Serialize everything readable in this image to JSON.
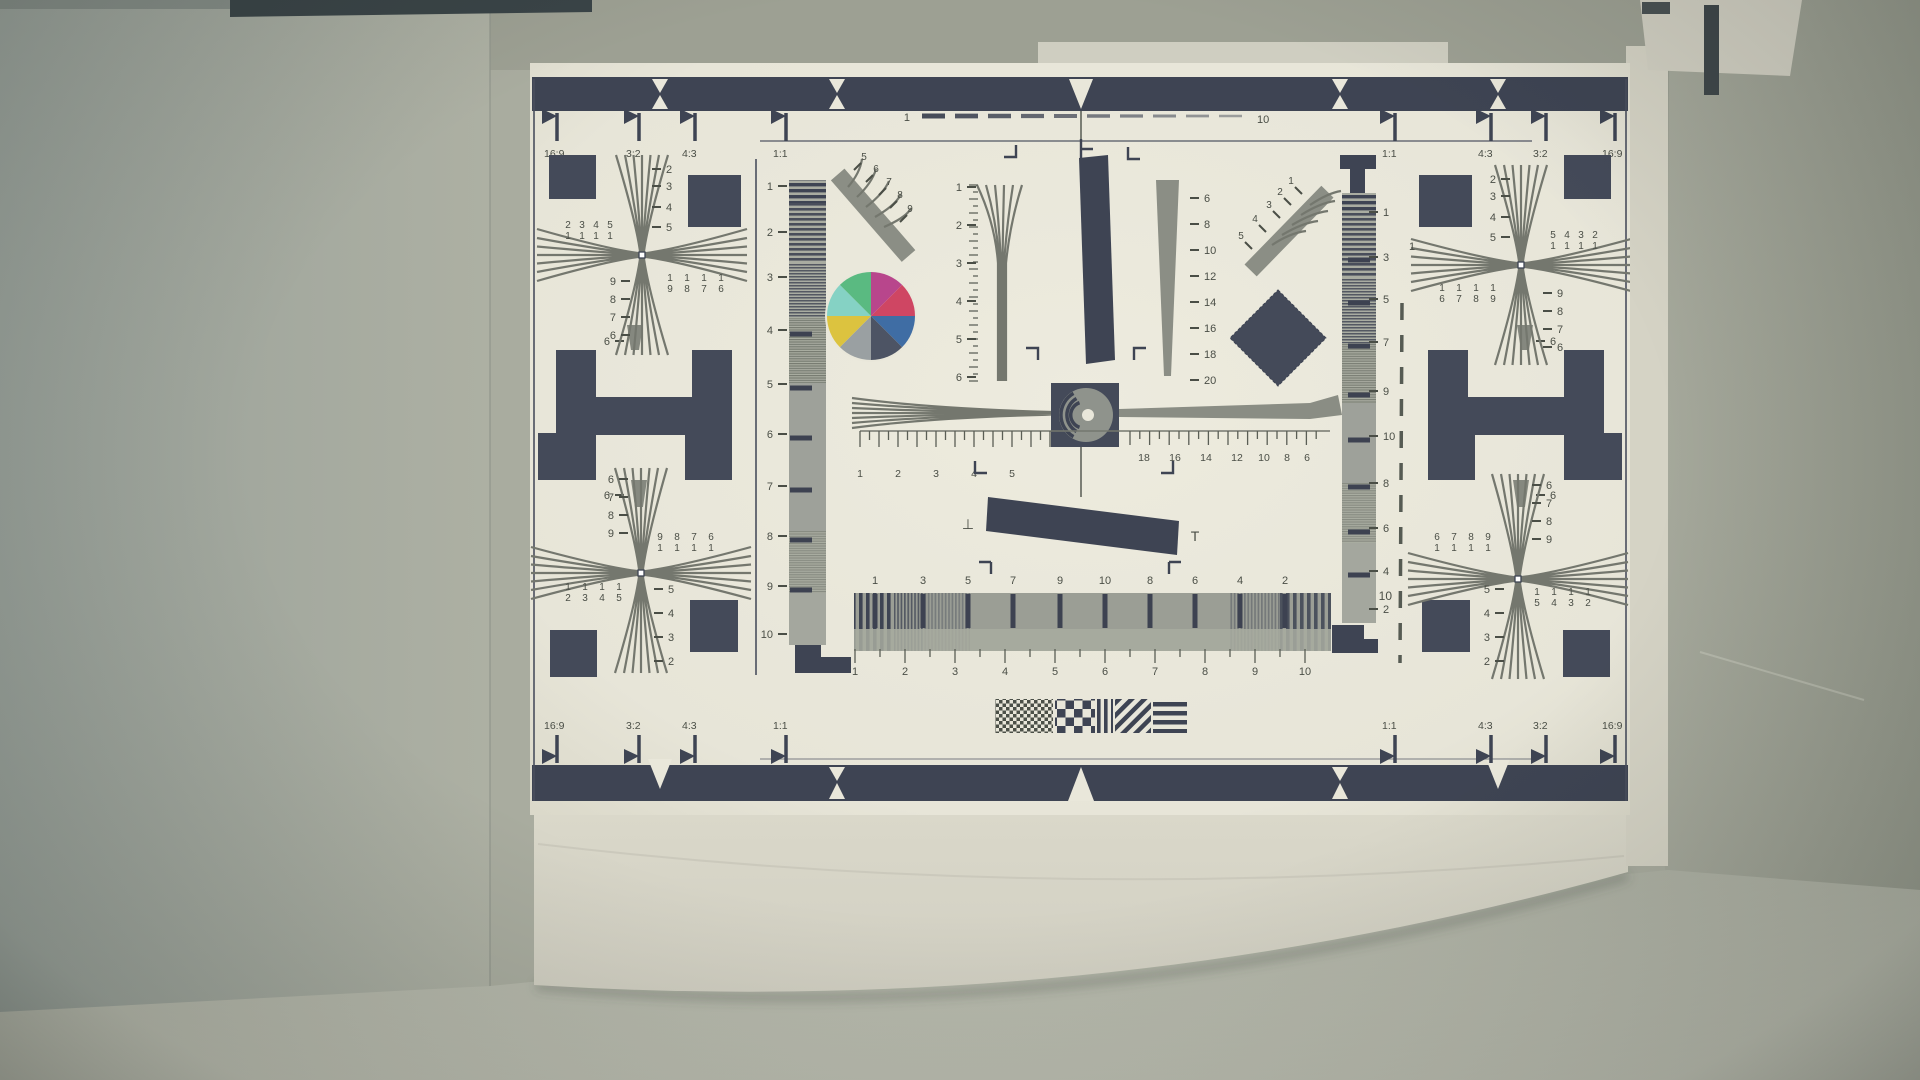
{
  "chart": {
    "aspect": {
      "tl": [
        "16:9",
        "3:2",
        "4:3",
        "1:1"
      ],
      "tr": [
        "1:1",
        "4:3",
        "3:2",
        "16:9"
      ],
      "bl": [
        "16:9",
        "3:2",
        "4:3",
        "1:1"
      ],
      "br": [
        "1:1",
        "4:3",
        "3:2",
        "16:9"
      ]
    },
    "dashed_scale": {
      "start": "1",
      "end": "10"
    },
    "left_scale": [
      "1",
      "2",
      "3",
      "4",
      "5",
      "6",
      "7",
      "8",
      "9",
      "10"
    ],
    "right_scale": [
      "1",
      "3",
      "5",
      "7",
      "9",
      "10",
      "8",
      "6",
      "4",
      "2"
    ],
    "right_dashed_scale": {
      "top": "1",
      "bottom": "10"
    },
    "center_left_wedge_scale": [
      "1",
      "2",
      "3",
      "4",
      "5",
      "6"
    ],
    "center_right_wedge_scale": [
      "6",
      "8",
      "10",
      "12",
      "14",
      "16",
      "18",
      "20"
    ],
    "center_ruler_left": [
      "1",
      "2",
      "3",
      "4",
      "5"
    ],
    "center_ruler_right": [
      "18",
      "16",
      "14",
      "12",
      "10",
      "8",
      "6"
    ],
    "bottom_sweep_top": [
      "1",
      "3",
      "5",
      "7",
      "9",
      "10",
      "8",
      "6",
      "4",
      "2"
    ],
    "bottom_sweep_bottom": [
      "1",
      "2",
      "3",
      "4",
      "5",
      "6",
      "7",
      "8",
      "9",
      "10"
    ],
    "left_fan_scale": [
      "5",
      "6",
      "7",
      "8",
      "9"
    ],
    "right_fan_scale": [
      "5",
      "4",
      "3",
      "2",
      "1"
    ],
    "h_marker_label": "6",
    "perp_marks": {
      "left": "⊥",
      "right": "T"
    },
    "crosses": {
      "tl": {
        "outer_v": [
          "2",
          "3",
          "4",
          "5"
        ],
        "outer_h_row1": [
          "2",
          "3",
          "4",
          "5"
        ],
        "outer_h_row2": [
          "1",
          "1",
          "1",
          "1"
        ],
        "inner_row1": [
          "1",
          "1",
          "1",
          "1"
        ],
        "inner_row2": [
          "9",
          "8",
          "7",
          "6"
        ],
        "inner_v": [
          "9",
          "8",
          "7",
          "6"
        ]
      },
      "tr": {
        "outer_v": [
          "2",
          "3",
          "4",
          "5"
        ],
        "outer_h_row1": [
          "5",
          "4",
          "3",
          "2"
        ],
        "outer_h_row2": [
          "1",
          "1",
          "1",
          "1"
        ],
        "inner_row1": [
          "1",
          "1",
          "1",
          "1"
        ],
        "inner_row2": [
          "6",
          "7",
          "8",
          "9"
        ],
        "inner_v": [
          "9",
          "8",
          "7",
          "6"
        ]
      },
      "bl": {
        "outer_v": [
          "6",
          "7",
          "8",
          "9"
        ],
        "outer_h_row1": [
          "9",
          "8",
          "7",
          "6"
        ],
        "outer_h_row2": [
          "1",
          "1",
          "1",
          "1"
        ],
        "inner_row1": [
          "1",
          "1",
          "1",
          "1"
        ],
        "inner_row2": [
          "2",
          "3",
          "4",
          "5"
        ],
        "inner_v": [
          "5",
          "4",
          "3",
          "2"
        ]
      },
      "br": {
        "outer_v": [
          "6",
          "7",
          "8",
          "9"
        ],
        "outer_h_row1": [
          "6",
          "7",
          "8",
          "9"
        ],
        "outer_h_row2": [
          "1",
          "1",
          "1",
          "1"
        ],
        "inner_row1": [
          "1",
          "1",
          "1",
          "1"
        ],
        "inner_row2": [
          "5",
          "4",
          "3",
          "2"
        ],
        "inner_v": [
          "5",
          "4",
          "3",
          "2"
        ]
      }
    },
    "colors": {
      "wheel": [
        "#b8468c",
        "#cf4663",
        "#3f6da4",
        "#4d5464",
        "#9aa0a2",
        "#dcc33f",
        "#85d2c4",
        "#5aba81"
      ],
      "ink": "#3e4453",
      "paper": "#e9e7da"
    }
  }
}
